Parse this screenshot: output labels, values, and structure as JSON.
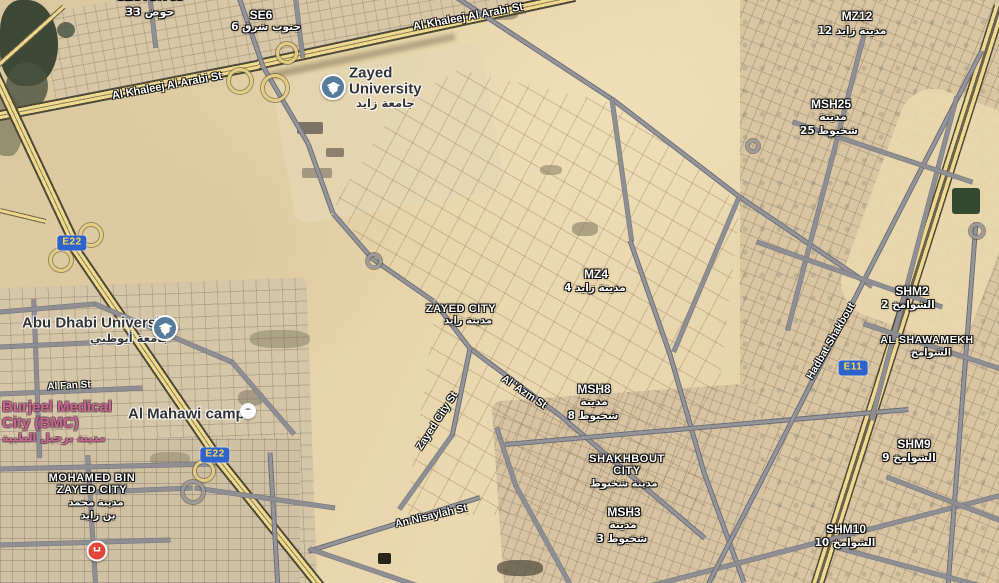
{
  "map": {
    "type": "satellite-map",
    "colors": {
      "highway_yellow": "#eed98f",
      "road_grey": "#949499",
      "badge_blue": "#2e63cf",
      "badge_text_yellow": "#ffd84d",
      "area_label_white": "#ffffff",
      "poi_text_dark": "#333336",
      "poi_health_pink": "#c9658f",
      "university_icon_blue": "#567b9b",
      "hospital_red": "#e3453a",
      "desert_sand": "#e4d1a6"
    },
    "area_labels": [
      {
        "text": "SECTOR 33",
        "x": 150,
        "y": -4,
        "size": 12
      },
      {
        "text": "حوض 33",
        "x": 150,
        "y": 12,
        "size": 11,
        "ar": true
      },
      {
        "text": "SE6",
        "x": 261,
        "y": 15,
        "size": 12
      },
      {
        "text": "جنوب شرق 6",
        "x": 266,
        "y": 27,
        "size": 10.5,
        "ar": true
      },
      {
        "text": "MZ12",
        "x": 857,
        "y": 16,
        "size": 12
      },
      {
        "text": "مدينة زايد 12",
        "x": 852,
        "y": 31,
        "size": 10.5,
        "ar": true
      },
      {
        "text": "MSH25",
        "x": 831,
        "y": 104,
        "size": 12
      },
      {
        "text": "مدينة",
        "x": 833,
        "y": 117,
        "size": 10.5,
        "ar": true
      },
      {
        "text": "شخبوط 25",
        "x": 829,
        "y": 131,
        "size": 10.5,
        "ar": true
      },
      {
        "text": "MZ4",
        "x": 596,
        "y": 274,
        "size": 12
      },
      {
        "text": "مدينة زايد 4",
        "x": 595,
        "y": 288,
        "size": 10.5,
        "ar": true
      },
      {
        "text": "ZAYED CITY",
        "x": 461,
        "y": 309,
        "size": 11,
        "ls": 0.6
      },
      {
        "text": "مدينة زايد",
        "x": 468,
        "y": 321,
        "size": 10,
        "ar": true
      },
      {
        "text": "MSH8",
        "x": 594,
        "y": 389,
        "size": 12
      },
      {
        "text": "مدينة",
        "x": 594,
        "y": 402,
        "size": 10.5,
        "ar": true
      },
      {
        "text": "شخبوط 8",
        "x": 593,
        "y": 416,
        "size": 10.5,
        "ar": true
      },
      {
        "text": "SHAKHBOUT",
        "x": 627,
        "y": 459,
        "size": 11,
        "ls": 0.6
      },
      {
        "text": "CITY",
        "x": 627,
        "y": 471,
        "size": 11,
        "ls": 0.6
      },
      {
        "text": "مدينة شخبوط",
        "x": 624,
        "y": 484,
        "size": 10,
        "ar": true
      },
      {
        "text": "MSH3",
        "x": 624,
        "y": 512,
        "size": 12
      },
      {
        "text": "مدينة",
        "x": 623,
        "y": 525,
        "size": 10.5,
        "ar": true
      },
      {
        "text": "شخبوط 3",
        "x": 622,
        "y": 539,
        "size": 10.5,
        "ar": true
      },
      {
        "text": "SHM2",
        "x": 912,
        "y": 291,
        "size": 12
      },
      {
        "text": "الشوامخ 2",
        "x": 908,
        "y": 305,
        "size": 10.5,
        "ar": true
      },
      {
        "text": "AL SHAWAMEKH",
        "x": 927,
        "y": 340,
        "size": 10.5,
        "ls": 0.6
      },
      {
        "text": "الشوامخ",
        "x": 931,
        "y": 353,
        "size": 10,
        "ar": true
      },
      {
        "text": "SHM9",
        "x": 914,
        "y": 444,
        "size": 12
      },
      {
        "text": "الشوامخ 9",
        "x": 909,
        "y": 458,
        "size": 10.5,
        "ar": true
      },
      {
        "text": "SHM10",
        "x": 846,
        "y": 529,
        "size": 12
      },
      {
        "text": "الشوامخ 10",
        "x": 845,
        "y": 543,
        "size": 10.5,
        "ar": true
      },
      {
        "text": "MOHAMED BIN",
        "x": 92,
        "y": 478,
        "size": 11,
        "ls": 0.6
      },
      {
        "text": "ZAYED CITY",
        "x": 92,
        "y": 490,
        "size": 11,
        "ls": 0.6
      },
      {
        "text": "مدينة محمد",
        "x": 96,
        "y": 503,
        "size": 10,
        "ar": true
      },
      {
        "text": "بن زايد",
        "x": 98,
        "y": 516,
        "size": 10,
        "ar": true
      }
    ],
    "road_labels": [
      {
        "text": "Al Khaleej Al Arabi St",
        "x": 167,
        "y": 86,
        "rot": -10.5,
        "size": 11
      },
      {
        "text": "Al Khaleej Al Arabi St",
        "x": 468,
        "y": 17,
        "rot": -10.5,
        "size": 11
      },
      {
        "text": "Al Fan St",
        "x": 69,
        "y": 386,
        "rot": -3,
        "size": 10
      },
      {
        "text": "Al 'Azm St",
        "x": 524,
        "y": 392,
        "rot": 34,
        "size": 10.5
      },
      {
        "text": "Zayed City St",
        "x": 437,
        "y": 421,
        "rot": -57,
        "size": 10.5
      },
      {
        "text": "An Nisaylah St",
        "x": 431,
        "y": 516,
        "rot": -13,
        "size": 10.5
      },
      {
        "text": "Hadbat Shakbout",
        "x": 831,
        "y": 341,
        "rot": -60,
        "size": 10.5
      }
    ],
    "route_badges": [
      {
        "text": "E22",
        "x": 72,
        "y": 243
      },
      {
        "text": "E22",
        "x": 215,
        "y": 455
      },
      {
        "text": "E11",
        "x": 853,
        "y": 368
      }
    ],
    "poi_texts": [
      {
        "text": "Zayed",
        "x": 349,
        "y": 73,
        "size": 15,
        "color": "dark"
      },
      {
        "text": "University",
        "x": 349,
        "y": 89,
        "size": 15,
        "color": "dark"
      },
      {
        "text": "جامعة زايد",
        "x": 356,
        "y": 103,
        "size": 11.5,
        "color": "dark",
        "ar": true
      },
      {
        "text": "Abu Dhabi University",
        "x": 22,
        "y": 323,
        "size": 15,
        "color": "dark"
      },
      {
        "text": "جامعة أبوظبي",
        "x": 90,
        "y": 338,
        "size": 11.5,
        "color": "dark",
        "ar": true
      },
      {
        "text": "Al Mahawi camp",
        "x": 128,
        "y": 414,
        "size": 15,
        "color": "dark"
      },
      {
        "text": "Burjeel Medical",
        "x": 2,
        "y": 407,
        "size": 15,
        "color": "pink"
      },
      {
        "text": "City (BMC)",
        "x": 2,
        "y": 423,
        "size": 15,
        "color": "pink"
      },
      {
        "text": "مدينة برجيل الطبية",
        "x": 2,
        "y": 438,
        "size": 11,
        "color": "pink",
        "ar": true
      }
    ],
    "poi_icons": [
      {
        "type": "graduation-cap",
        "x": 333,
        "y": 87
      },
      {
        "type": "graduation-cap",
        "x": 165,
        "y": 328
      },
      {
        "type": "generic-poi",
        "x": 248,
        "y": 411
      },
      {
        "type": "hospital",
        "x": 97,
        "y": 551,
        "letter": "H"
      }
    ],
    "roads": [
      [
        -15,
        118,
        262,
        64,
        "hwy"
      ],
      [
        258,
        64,
        575,
        -4,
        "hwy"
      ],
      [
        -15,
        52,
        76,
        246,
        "hwy"
      ],
      [
        72,
        244,
        218,
        458,
        "hwy"
      ],
      [
        216,
        456,
        325,
        592,
        "hwy"
      ],
      [
        1000,
        6,
        816,
        588,
        "hwy2"
      ],
      [
        -12,
        74,
        64,
        6,
        "ramp"
      ],
      [
        0,
        210,
        46,
        221,
        "ramp"
      ],
      [
        270,
        75,
        455,
        36,
        "shadow"
      ],
      [
        452,
        -6,
        614,
        100,
        "major"
      ],
      [
        614,
        100,
        739,
        196,
        "major"
      ],
      [
        739,
        196,
        872,
        286,
        "major"
      ],
      [
        238,
        -6,
        263,
        66,
        "major"
      ],
      [
        263,
        66,
        308,
        143,
        "major"
      ],
      [
        308,
        143,
        333,
        213,
        "major"
      ],
      [
        333,
        213,
        372,
        258,
        "major"
      ],
      [
        372,
        258,
        434,
        301,
        "major"
      ],
      [
        434,
        301,
        470,
        348,
        "major"
      ],
      [
        470,
        348,
        560,
        415,
        "major"
      ],
      [
        560,
        415,
        705,
        538,
        "major"
      ],
      [
        470,
        348,
        452,
        436,
        "major"
      ],
      [
        452,
        436,
        400,
        509,
        "minor"
      ],
      [
        480,
        497,
        308,
        551,
        "major"
      ],
      [
        310,
        549,
        424,
        588,
        "minor"
      ],
      [
        612,
        98,
        632,
        242,
        "minor"
      ],
      [
        630,
        240,
        670,
        354,
        "major"
      ],
      [
        670,
        354,
        704,
        472,
        "major"
      ],
      [
        704,
        472,
        744,
        582,
        "major"
      ],
      [
        739,
        198,
        674,
        352,
        "minor"
      ],
      [
        505,
        444,
        908,
        409,
        "major"
      ],
      [
        497,
        428,
        516,
        486,
        "minor"
      ],
      [
        516,
        486,
        570,
        584,
        "minor"
      ],
      [
        642,
        588,
        1006,
        494,
        "minor"
      ],
      [
        982,
        50,
        707,
        586,
        "major"
      ],
      [
        976,
        222,
        948,
        586,
        "major"
      ],
      [
        864,
        36,
        788,
        330,
        "minor"
      ],
      [
        957,
        97,
        872,
        420,
        "minor"
      ],
      [
        793,
        122,
        972,
        182,
        "minor"
      ],
      [
        757,
        242,
        942,
        307,
        "minor"
      ],
      [
        864,
        324,
        1004,
        370,
        "minor"
      ],
      [
        887,
        477,
        1004,
        522,
        "minor"
      ],
      [
        838,
        548,
        1004,
        592,
        "minor"
      ],
      [
        0,
        394,
        142,
        388,
        "minor"
      ],
      [
        34,
        300,
        40,
        458,
        "minor"
      ],
      [
        0,
        347,
        130,
        341,
        "minor"
      ],
      [
        0,
        312,
        95,
        304,
        "minor"
      ],
      [
        95,
        304,
        232,
        362,
        "minor"
      ],
      [
        232,
        362,
        294,
        434,
        "minor"
      ],
      [
        88,
        456,
        96,
        588,
        "minor"
      ],
      [
        270,
        452,
        278,
        588,
        "major"
      ],
      [
        0,
        469,
        215,
        464,
        "minor"
      ],
      [
        0,
        545,
        170,
        540,
        "minor"
      ],
      [
        96,
        492,
        192,
        488,
        "minor"
      ],
      [
        195,
        488,
        335,
        508,
        "minor"
      ],
      [
        296,
        0,
        303,
        58,
        "minor"
      ],
      [
        150,
        -4,
        156,
        48,
        "minor"
      ]
    ],
    "rings": [
      {
        "x": 237,
        "y": 78,
        "r": 10
      },
      {
        "x": 272,
        "y": 85,
        "r": 11
      },
      {
        "x": 284,
        "y": 50,
        "r": 8
      },
      {
        "x": 58,
        "y": 257,
        "r": 9
      },
      {
        "x": 88,
        "y": 232,
        "r": 9
      },
      {
        "x": 201,
        "y": 468,
        "r": 8
      },
      {
        "x": 371,
        "y": 258,
        "r": 5,
        "grey": true
      },
      {
        "x": 750,
        "y": 143,
        "r": 4,
        "grey": true
      },
      {
        "x": 190,
        "y": 489,
        "r": 9,
        "grey": true
      },
      {
        "x": 974,
        "y": 228,
        "r": 5,
        "grey": true
      }
    ],
    "spots": [
      {
        "x": 0,
        "y": 0,
        "w": 58,
        "h": 86,
        "c": "#37412f",
        "r": "40% 60% 55% 45%",
        "o": 0.95
      },
      {
        "x": 6,
        "y": 62,
        "w": 42,
        "h": 48,
        "c": "#4a5240",
        "r": "50%",
        "o": 0.8
      },
      {
        "x": 57,
        "y": 22,
        "w": 18,
        "h": 16,
        "c": "#45503c",
        "r": "50%",
        "o": 0.8
      },
      {
        "x": -8,
        "y": 96,
        "w": 30,
        "h": 60,
        "c": "#5c6148",
        "r": "40%",
        "o": 0.55
      },
      {
        "x": 952,
        "y": 188,
        "w": 28,
        "h": 26,
        "c": "#1f3b23",
        "r": "3px",
        "o": 0.9
      },
      {
        "x": 297,
        "y": 122,
        "w": 26,
        "h": 12,
        "c": "#6b6257",
        "r": "2px",
        "o": 0.85
      },
      {
        "x": 326,
        "y": 148,
        "w": 18,
        "h": 9,
        "c": "#756a5c",
        "r": "2px",
        "o": 0.8
      },
      {
        "x": 302,
        "y": 168,
        "w": 30,
        "h": 10,
        "c": "#8a7f6e",
        "r": "2px",
        "o": 0.7
      },
      {
        "x": 572,
        "y": 222,
        "w": 26,
        "h": 14,
        "c": "#6f6a55",
        "r": "40%",
        "o": 0.5
      },
      {
        "x": 540,
        "y": 165,
        "w": 22,
        "h": 10,
        "c": "#7d7660",
        "r": "40%",
        "o": 0.5
      },
      {
        "x": 488,
        "y": 8,
        "w": 30,
        "h": 12,
        "c": "#6e6a52",
        "r": "40%",
        "o": 0.5
      },
      {
        "x": 378,
        "y": 553,
        "w": 13,
        "h": 11,
        "c": "#1d1a14",
        "r": "2px",
        "o": 0.95
      },
      {
        "x": 497,
        "y": 560,
        "w": 46,
        "h": 16,
        "c": "#4f4a3a",
        "r": "40%",
        "o": 0.7
      },
      {
        "x": 238,
        "y": 390,
        "w": 26,
        "h": 16,
        "c": "#77705d",
        "r": "40%",
        "o": 0.5
      },
      {
        "x": 150,
        "y": 452,
        "w": 40,
        "h": 14,
        "c": "#8a8068",
        "r": "40%",
        "o": 0.5
      },
      {
        "x": 250,
        "y": 330,
        "w": 60,
        "h": 18,
        "c": "#6d6b52",
        "r": "40%",
        "o": 0.4
      }
    ]
  }
}
